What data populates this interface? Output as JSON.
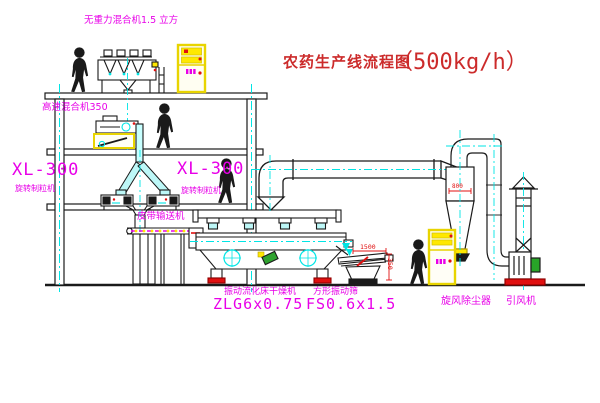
{
  "title": {
    "cn": "农药生产线流程图",
    "capacity": "（500kg/h）"
  },
  "labels": {
    "top_mixer": "无重力混合机1.5 立方",
    "hs_mixer": "高速混合机350",
    "xl300_left": {
      "model": "XL-300",
      "name": "旋转制粒机"
    },
    "xl300_mid": {
      "model": "XL-300",
      "name": "旋转制粒机"
    },
    "belt_conveyor": "皮带输送机",
    "dryer": {
      "name": "振动流化床干燥机",
      "model": "ZLG6x0.75"
    },
    "screen": {
      "name": "方形振动筛",
      "model": "FS0.6x1.5"
    },
    "cyclone": "旋风除尘器",
    "fan": "引风机"
  },
  "dimensions": {
    "screen_length": "1500",
    "screen_height": "350",
    "cyclone_width": "800"
  },
  "colors": {
    "label_magenta": "#E800E8",
    "title_red": "#CC2B2B",
    "dimension_red": "#E01010",
    "centerline_cyan": "#00E5E5",
    "highlight_yellow": "#FFE800",
    "line_black": "#1A1A1A"
  }
}
